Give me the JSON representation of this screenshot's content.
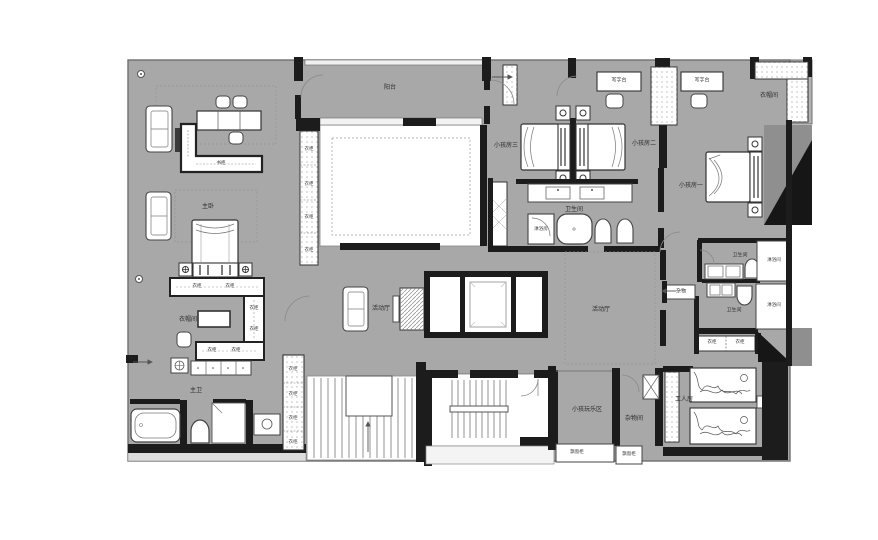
{
  "plan": {
    "type": "residential-floor-plan",
    "colors": {
      "floor": "#a8a8a8",
      "wall": "#1c1c1c",
      "room_fill": "#ffffff",
      "shadow_mid": "#8f8f8f",
      "shadow_dark": "#161616",
      "outline": "#6f6f6f"
    },
    "rooms": {
      "balcony": "阳台",
      "master_bedroom": "主卧",
      "master_closet": "衣帽间",
      "master_bath": "主卫",
      "kids_room_1": "小孩房一",
      "kids_room_2": "小孩房二",
      "kids_room_3": "小孩房三",
      "kids_bath": "卫生间",
      "kids_bath_shower": "淋浴房",
      "activity_hall_a": "活动厅",
      "activity_hall_b": "活动厅",
      "play_area": "小孩玩乐区",
      "storage_room": "杂物间",
      "worker_room": "工人房",
      "closet_top_right": "衣帽间",
      "bath_right_upper": "卫生间",
      "bath_right_lower": "卫生间",
      "shower_right_upper": "淋浴间",
      "shower_right_lower": "淋浴间",
      "sundries": "杂物"
    },
    "furniture": {
      "desk_1": "写字台",
      "desk_2": "写字台",
      "bookcase": "书柜",
      "bay_cabinet_1": "飘窗柜",
      "bay_cabinet_2": "飘窗柜",
      "wardrobe_void": [
        "衣柜",
        "衣柜",
        "衣柜",
        "衣柜"
      ],
      "wardrobe_master": [
        "衣柜",
        "衣柜",
        "衣柜",
        "衣柜",
        "衣柜",
        "衣柜"
      ],
      "wardrobe_corridor": [
        "衣柜",
        "衣柜",
        "衣柜",
        "衣柜"
      ],
      "wardrobe_worker": [
        "衣柜",
        "衣柜"
      ]
    }
  }
}
